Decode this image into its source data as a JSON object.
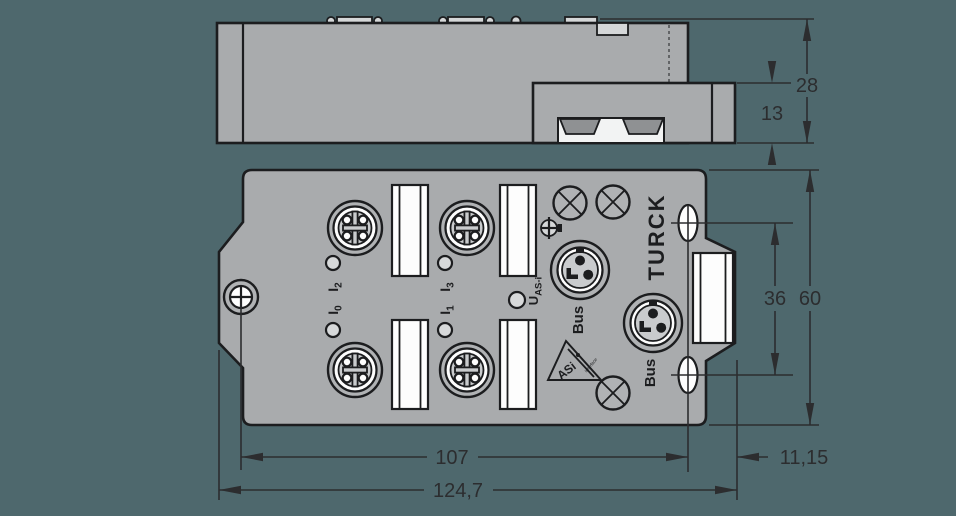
{
  "drawing": {
    "background_color": "#4e686d",
    "housing_color": "#a9abad",
    "line_color": "#1c1d1f",
    "accent_white": "#fdfdfd"
  },
  "side_view": {
    "dim_total_height": "28",
    "dim_bracket_height": "13"
  },
  "front_view": {
    "brand": "TURCK",
    "port_labels": [
      {
        "main": "I",
        "sub": "2"
      },
      {
        "main": "I",
        "sub": "3"
      },
      {
        "main": "I",
        "sub": "0"
      },
      {
        "main": "I",
        "sub": "1"
      }
    ],
    "bus_label_top": "Bus",
    "bus_label_bottom": "Bus",
    "voltage_label": {
      "main": "U",
      "sub": "AS-i"
    },
    "asi_logo": {
      "main": "ASi",
      "sub": "interface"
    },
    "dim_hole_spacing": "107",
    "dim_overall_width": "124,7",
    "dim_slot_edge_offset": "11,15",
    "dim_slot_spacing": "36",
    "dim_overall_height": "60"
  },
  "icons": {
    "m12-connector-icon": "concentric circles, cross key, 4 pin holes",
    "m8-bus-connector-icon": "circle with 3 pins and key notch",
    "knockout-icon": "circle with diagonal cross",
    "ground-terminal-icon": "circle with crosshair",
    "mounting-screw-icon": "circle with phillips cross",
    "mounting-slot-icon": "oval slot with centre lines"
  }
}
